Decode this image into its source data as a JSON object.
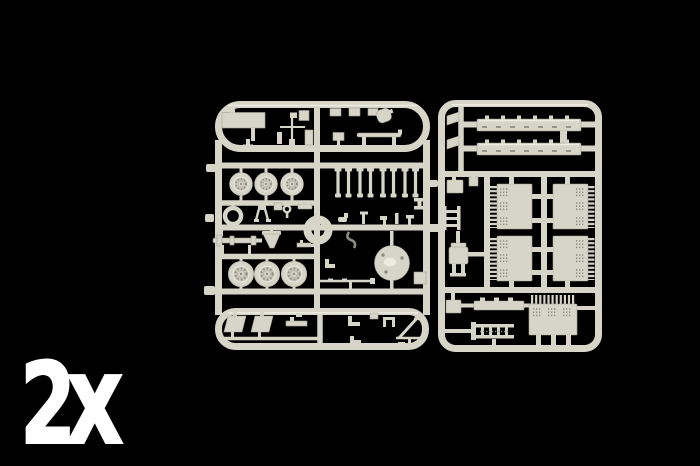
{
  "meta": {
    "description": "Product photograph of light-grey injection-moulded plastic model kit sprues (parts frames) on a black background. The 2x marking indicates two identical sprues are included."
  },
  "colors": {
    "background": "#000000",
    "plastic": "#d7d5c7",
    "plastic_light": "#edece3",
    "plastic_mid": "#c6c4b6",
    "plastic_dark": "#a8a698",
    "plastic_shadow": "#8e8c80",
    "label": "#ffffff"
  },
  "overlay": {
    "quantity_label": "2x"
  },
  "sprues": {
    "left": {
      "name": "parts sprue A",
      "visible_parts": [
        "rectangular hull plate",
        "antenna mast cross",
        "stowage boxes",
        "canteen",
        "running board",
        "road wheels (6)",
        "spare tyre ring",
        "tripod bracket",
        "eye bolt",
        "axle shaft",
        "suspension posts (8)",
        "control levers",
        "tow hook",
        "round turret base disc",
        "gun barrel rod",
        "mudguards (2)",
        "angle brackets",
        "aerial rod"
      ]
    },
    "right": {
      "name": "parts sprue B",
      "visible_parts": [
        "air horns (2)",
        "tread plates (2)",
        "louvred engine grilles (4)",
        "radiator grille",
        "driver seat",
        "step ladder",
        "tool box",
        "side ladder frame"
      ]
    }
  }
}
